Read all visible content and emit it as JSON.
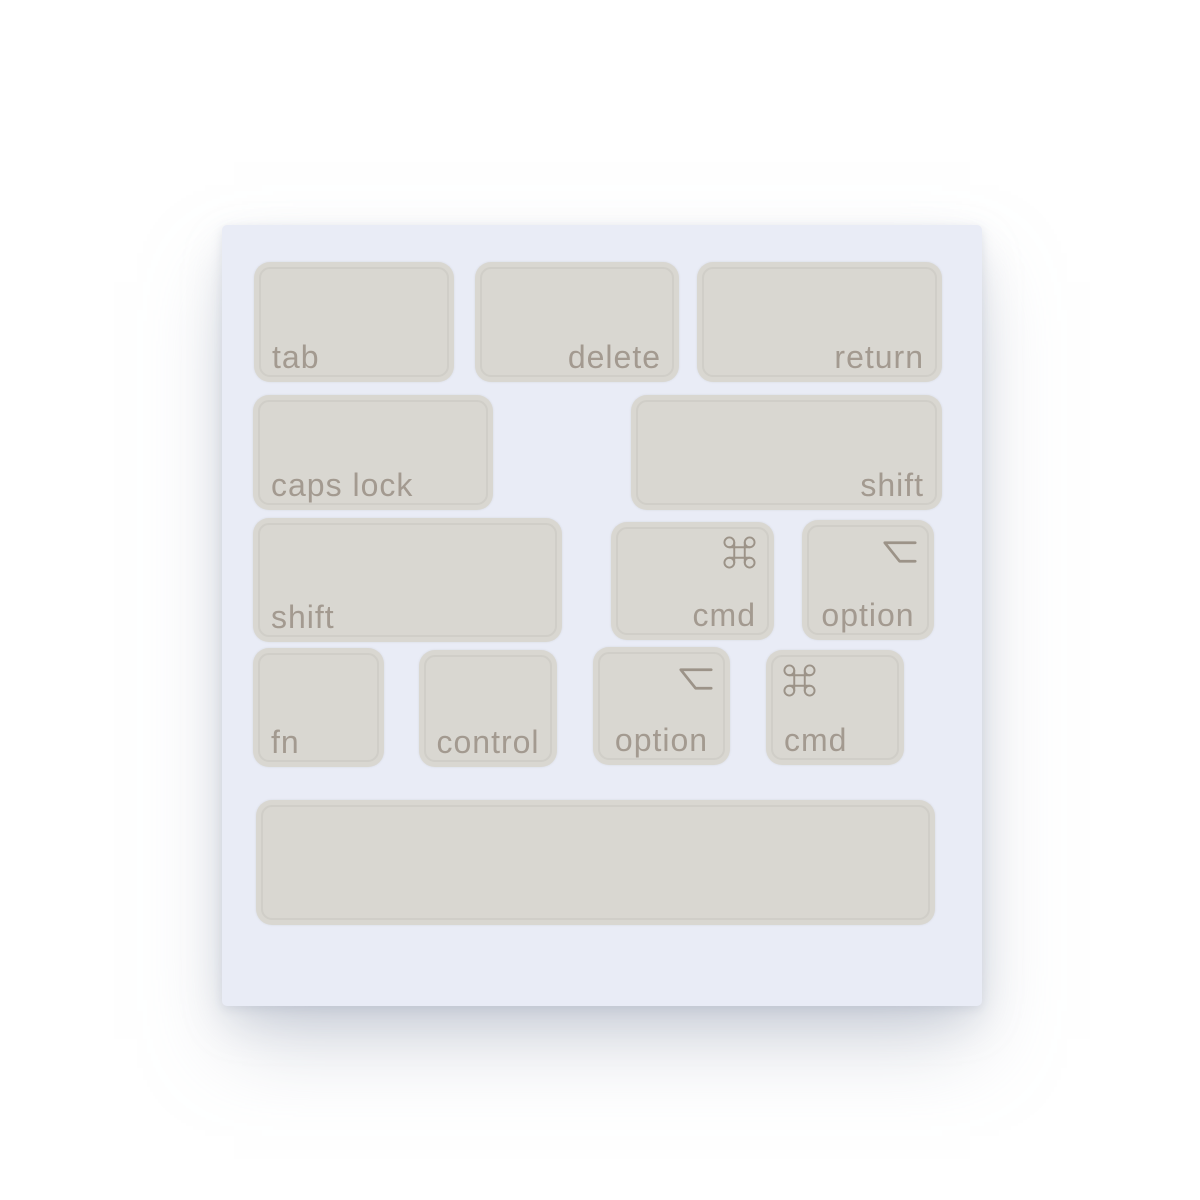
{
  "photo": {
    "subject_keys_text": [
      "tab",
      "delete",
      "return",
      "caps lock",
      "shift",
      "shift",
      "cmd",
      "option",
      "fn",
      "control",
      "option",
      "cmd",
      ""
    ],
    "symbols": {
      "command": "⌘",
      "option": "⌥"
    }
  },
  "colors": {
    "page_bg": "#ffffff",
    "sheet_bg": "#e9ecf6",
    "sticker_bg": "#d9d7d1",
    "sticker_keyline": "#c6c3bc",
    "label_color": "#a39a90",
    "symbol_color": "#9c9388",
    "shadow": "#a8b0c0"
  },
  "sheet": {
    "keys": [
      {
        "id": "tab",
        "label": "tab",
        "symbol": "",
        "icon": null,
        "icon_pos": null,
        "align": "left",
        "x": 32,
        "y": 37,
        "w": 200,
        "h": 120
      },
      {
        "id": "delete",
        "label": "delete",
        "symbol": "",
        "icon": null,
        "icon_pos": null,
        "align": "right",
        "x": 253,
        "y": 37,
        "w": 204,
        "h": 120
      },
      {
        "id": "return",
        "label": "return",
        "symbol": "",
        "icon": null,
        "icon_pos": null,
        "align": "right",
        "x": 475,
        "y": 37,
        "w": 245,
        "h": 120
      },
      {
        "id": "caps-lock",
        "label": "caps lock",
        "symbol": "",
        "icon": null,
        "icon_pos": null,
        "align": "left",
        "x": 31,
        "y": 170,
        "w": 240,
        "h": 115
      },
      {
        "id": "shift-right",
        "label": "shift",
        "symbol": "",
        "icon": null,
        "icon_pos": null,
        "align": "right",
        "x": 409,
        "y": 170,
        "w": 311,
        "h": 115
      },
      {
        "id": "shift-left",
        "label": "shift",
        "symbol": "",
        "icon": null,
        "icon_pos": null,
        "align": "left",
        "x": 31,
        "y": 293,
        "w": 309,
        "h": 124
      },
      {
        "id": "cmd-right",
        "label": "cmd",
        "symbol": "⌘",
        "icon": "command",
        "icon_pos": "right",
        "align": "right",
        "x": 389,
        "y": 297,
        "w": 163,
        "h": 118
      },
      {
        "id": "option-right",
        "label": "option",
        "symbol": "⌥",
        "icon": "option",
        "icon_pos": "right",
        "align": "center",
        "x": 580,
        "y": 295,
        "w": 132,
        "h": 120
      },
      {
        "id": "fn",
        "label": "fn",
        "symbol": "",
        "icon": null,
        "icon_pos": null,
        "align": "left",
        "x": 31,
        "y": 423,
        "w": 131,
        "h": 119
      },
      {
        "id": "control",
        "label": "control",
        "symbol": "",
        "icon": null,
        "icon_pos": null,
        "align": "center",
        "x": 197,
        "y": 425,
        "w": 138,
        "h": 117
      },
      {
        "id": "option-left",
        "label": "option",
        "symbol": "⌥",
        "icon": "option",
        "icon_pos": "right",
        "align": "center",
        "x": 371,
        "y": 422,
        "w": 137,
        "h": 118
      },
      {
        "id": "cmd-left",
        "label": "cmd",
        "symbol": "⌘",
        "icon": "command",
        "icon_pos": "left",
        "align": "left",
        "x": 544,
        "y": 425,
        "w": 138,
        "h": 115
      },
      {
        "id": "spacebar",
        "label": "",
        "symbol": "",
        "icon": null,
        "icon_pos": null,
        "align": "center",
        "x": 34,
        "y": 575,
        "w": 679,
        "h": 125
      }
    ]
  }
}
